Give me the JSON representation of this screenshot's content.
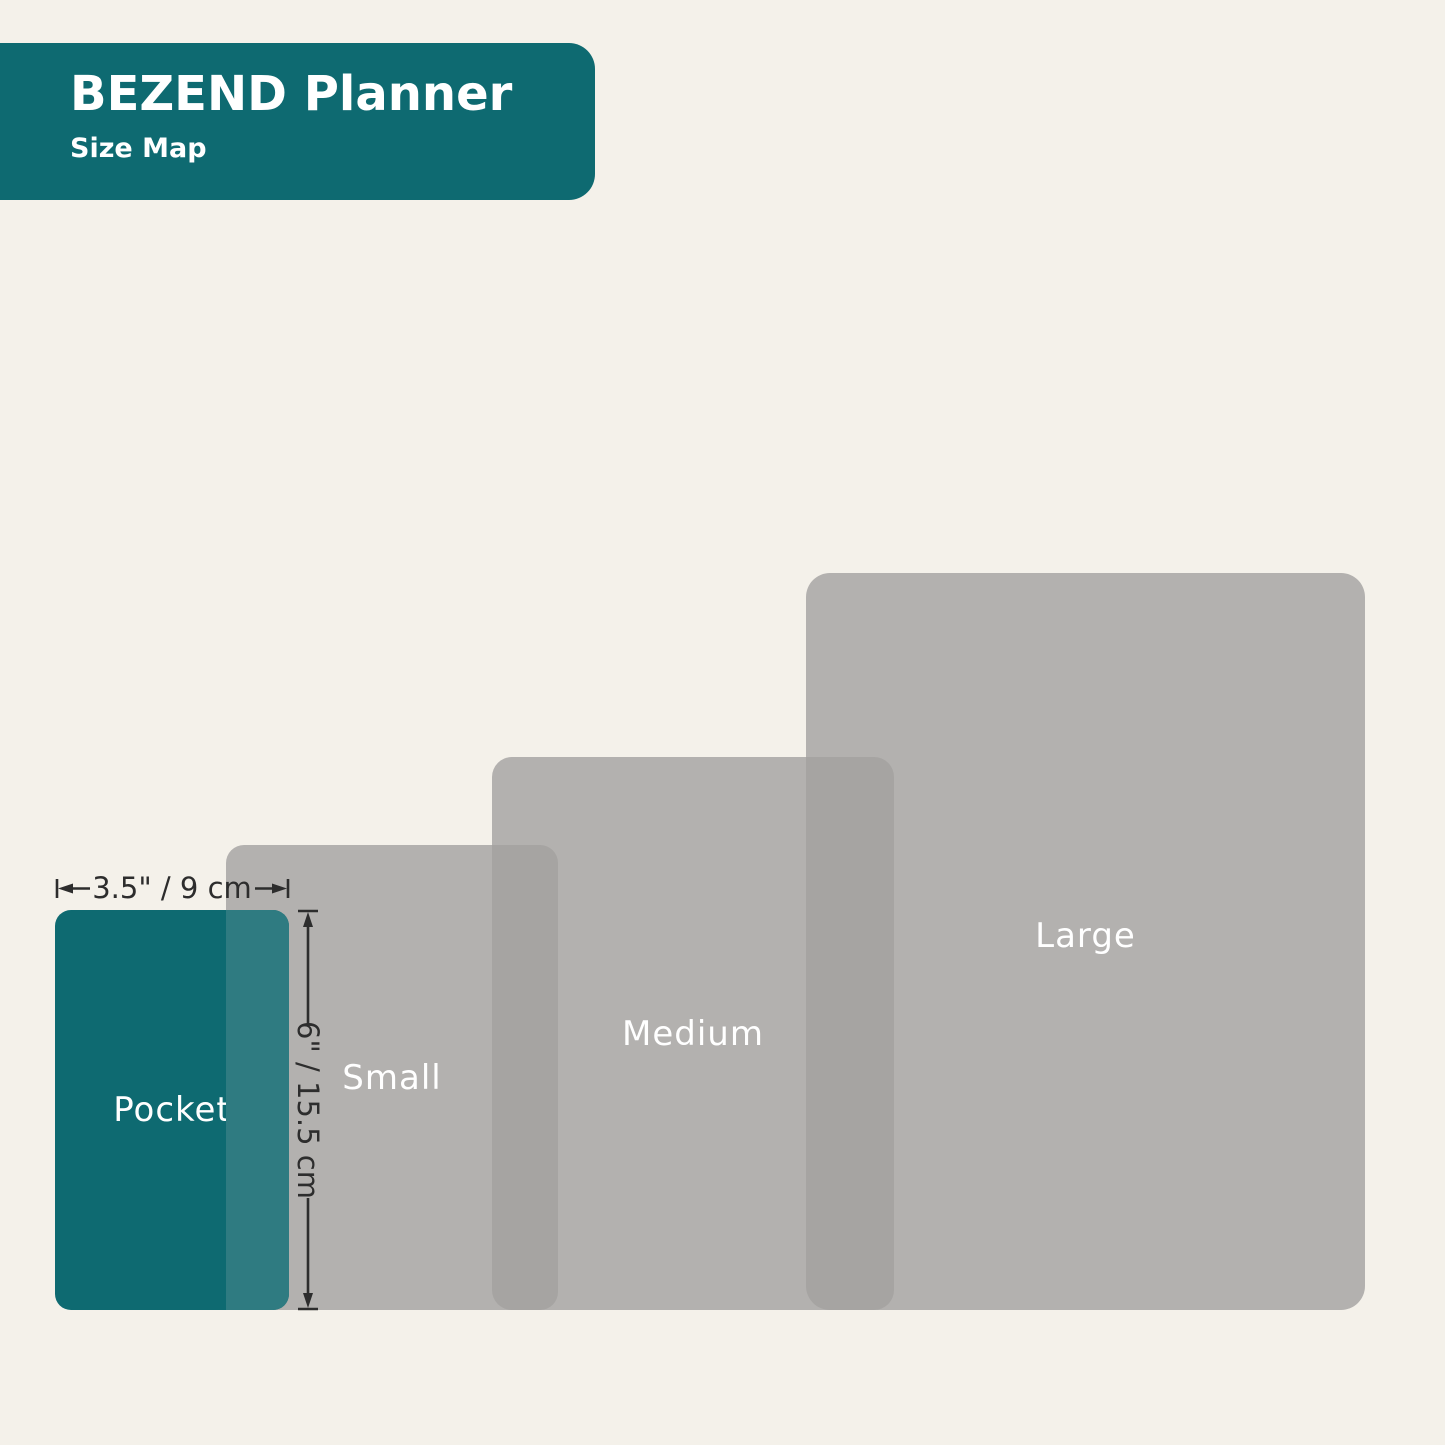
{
  "header": {
    "title": "BEZEND Planner",
    "subtitle": "Size Map"
  },
  "sizes": [
    {
      "label": "Pocket"
    },
    {
      "label": "Small"
    },
    {
      "label": "Medium"
    },
    {
      "label": "Large"
    }
  ],
  "dimensions": {
    "width_label": "3.5\" / 9 cm",
    "height_label": "6\" / 15.5 cm"
  },
  "colors": {
    "background": "#F4F1EA",
    "teal": "#0E6A71",
    "teal_overlap": "#2F7B81",
    "gray": "#B3B1AF",
    "gray_overlap": "#A6A4A2",
    "label_text": "#FFFFFF",
    "text_dark": "#2D2D2D"
  }
}
